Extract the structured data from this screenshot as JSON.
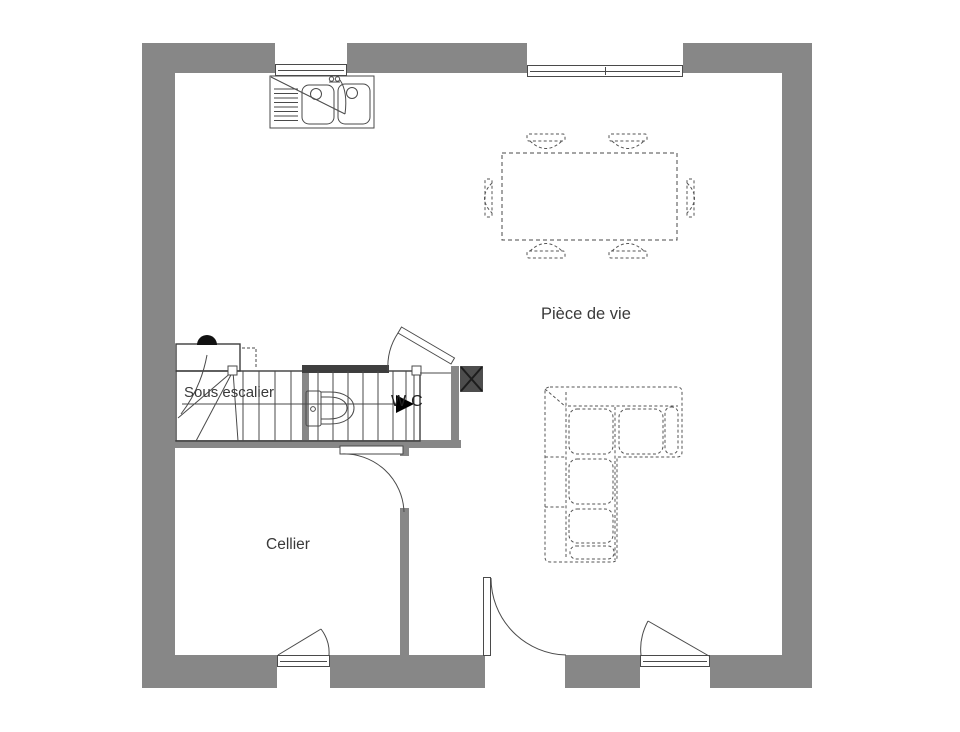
{
  "floor_plan": {
    "rooms": {
      "living_room_label": "Pièce de vie",
      "cellar_label": "Cellier",
      "under_stairs_label": "Sous escalier",
      "wc_label": "WC"
    },
    "colors": {
      "wall": "#878787",
      "wall_dark": "#3f3f3f",
      "duct_fill": "#4d4d4d",
      "line": "#4a4a4a",
      "background": "#ffffff"
    }
  }
}
